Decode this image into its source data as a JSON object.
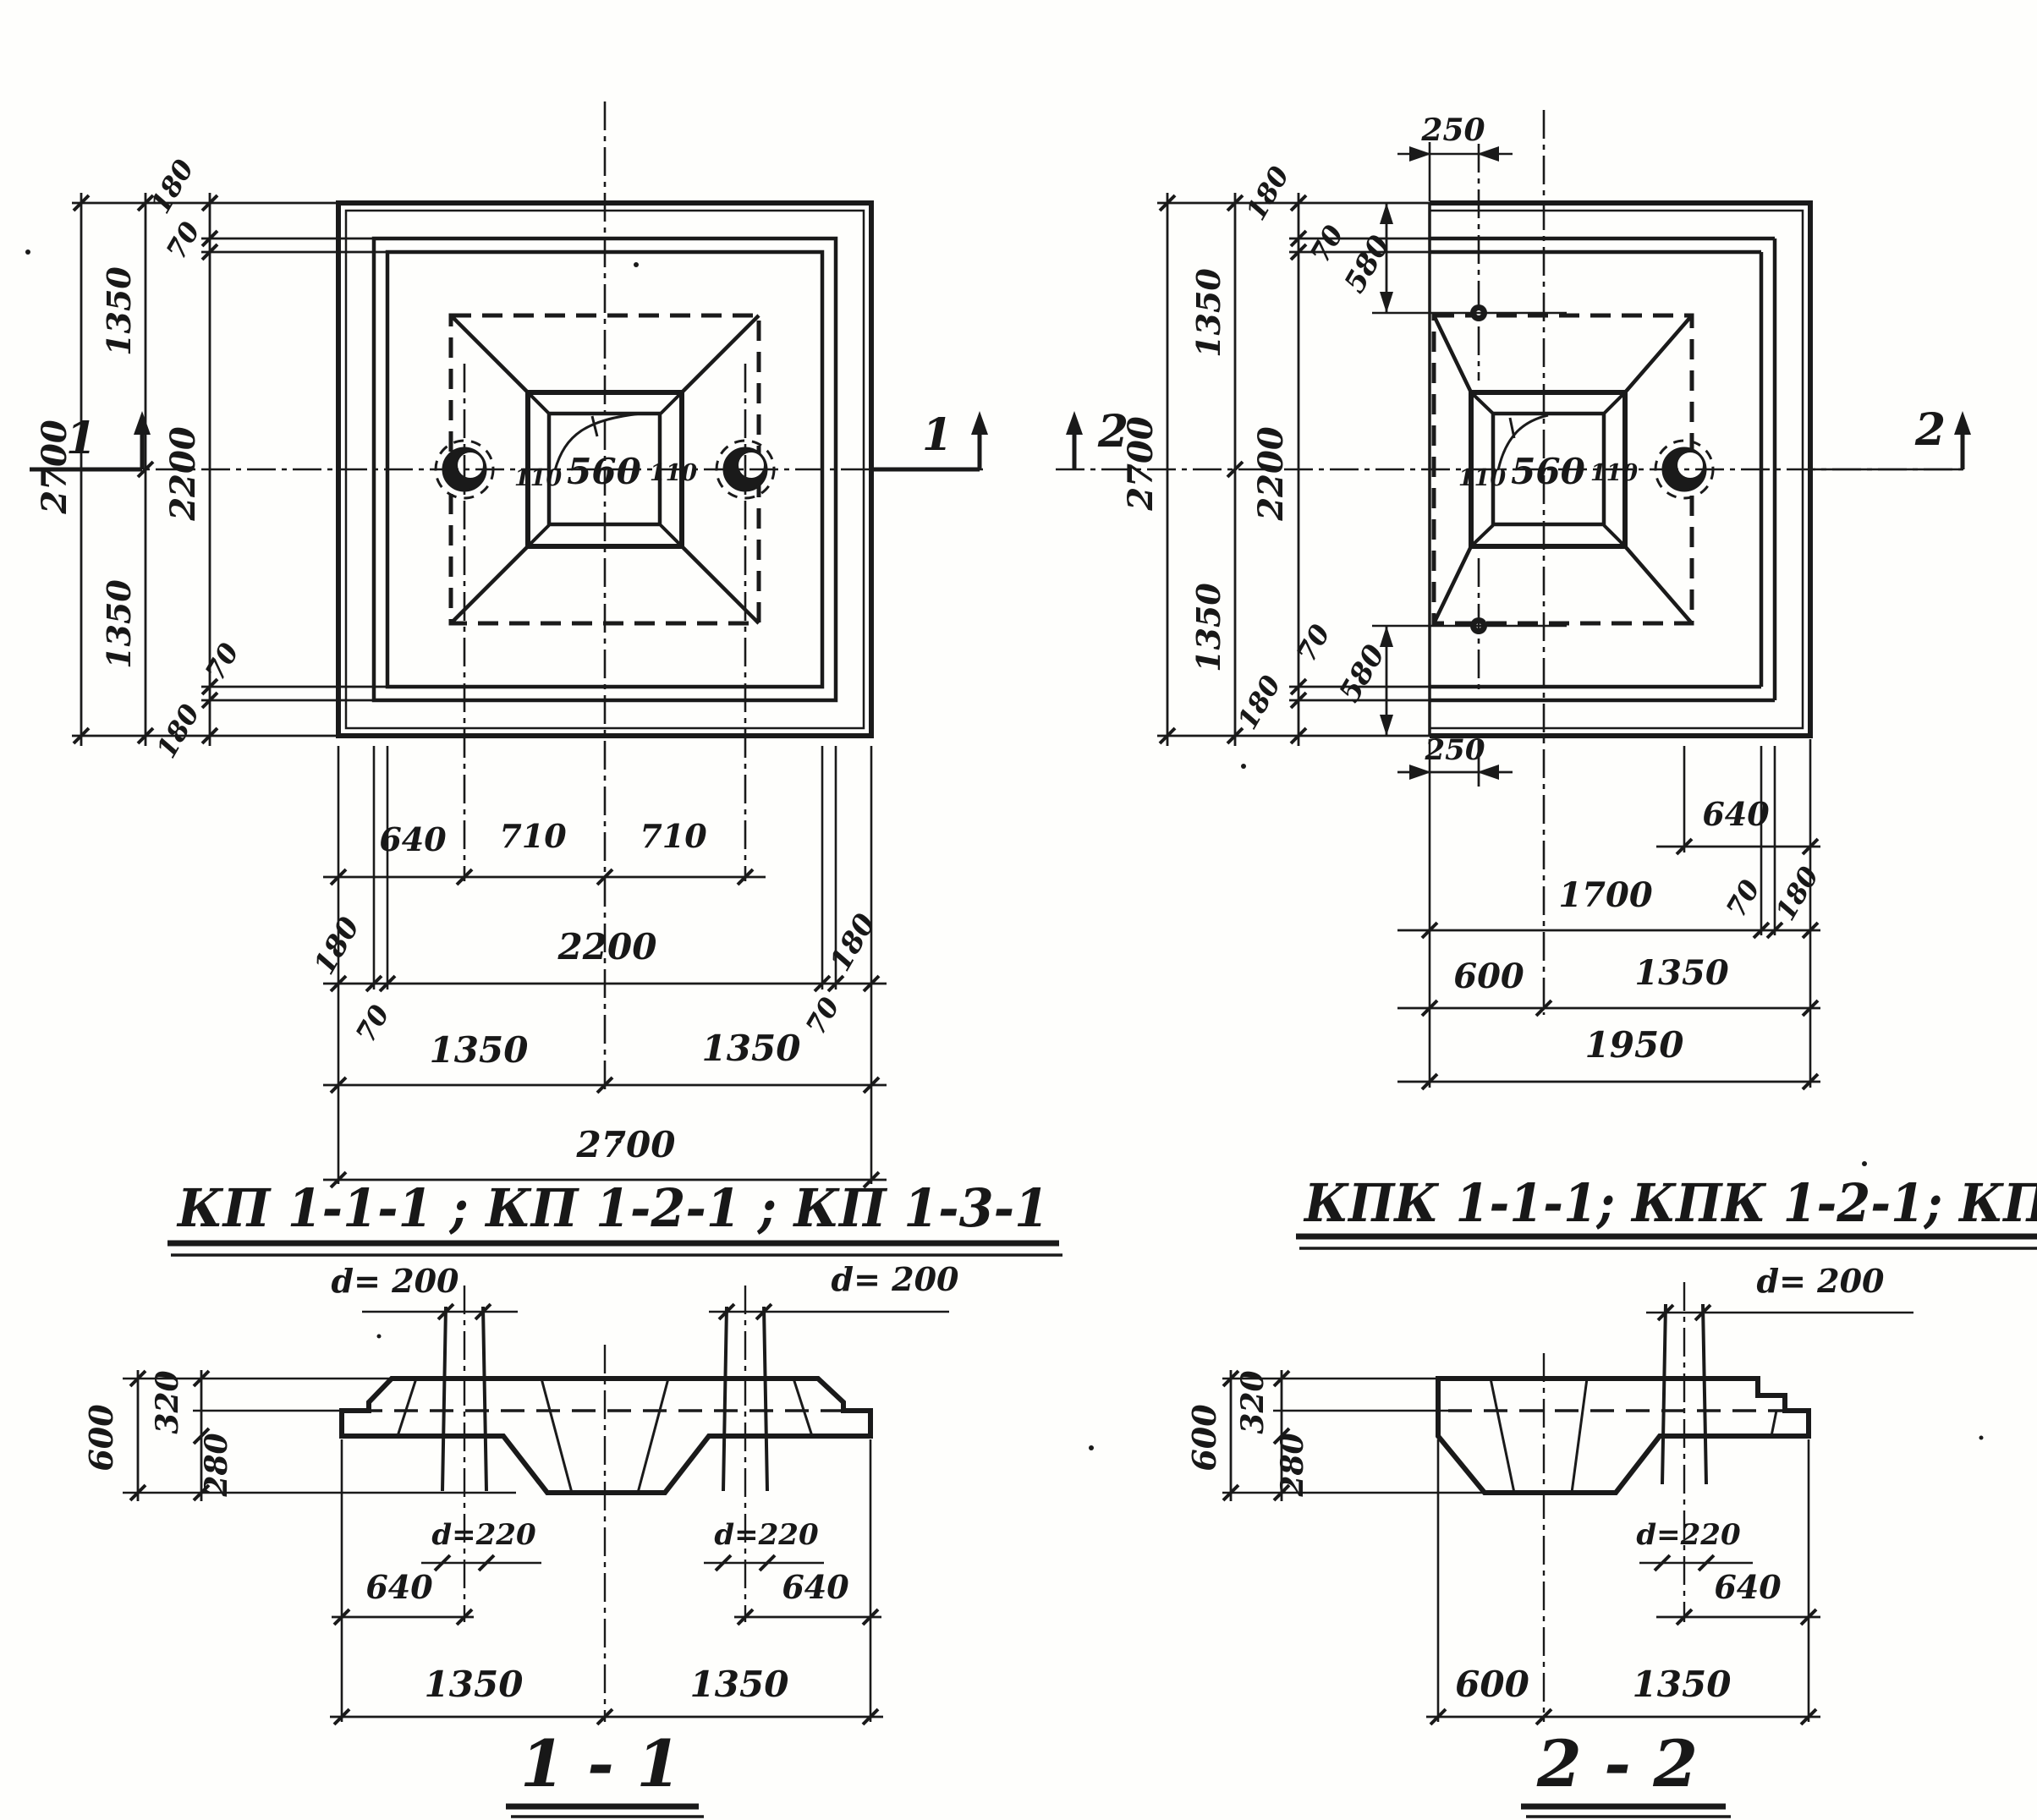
{
  "ink": "#1a1a1a",
  "paper": "#fefefc",
  "heading_left": "КП 1-1-1 ; КП 1-2-1 ; КП 1-3-1",
  "heading_right": "КПК 1-1-1; КПК 1-2-1; КПК 1-3-1",
  "plan_left": {
    "marker": "1",
    "v2700": "2700",
    "v1350t": "1350",
    "v1350b": "1350",
    "v2200": "2200",
    "v180t": "180",
    "v70t": "70",
    "v70b": "70",
    "v180b": "180",
    "s110l": "110",
    "s560": "560",
    "s110r": "110",
    "b640": "640",
    "b710l": "710",
    "b710r": "710",
    "b180l": "180",
    "b2200": "2200",
    "b180r": "180",
    "b70l": "70",
    "b70r": "70",
    "b1350l": "1350",
    "b1350r": "1350",
    "b2700": "2700"
  },
  "plan_right": {
    "marker": "2",
    "t250": "250",
    "v2700": "2700",
    "v1350t": "1350",
    "v1350b": "1350",
    "v2200": "2200",
    "v180t": "180",
    "v70t": "70",
    "v580t": "580",
    "v70b": "70",
    "v580b": "580",
    "v180b": "180",
    "s110l": "110",
    "s560": "560",
    "s110r": "110",
    "b250": "250",
    "b640": "640",
    "b1700": "1700",
    "b70": "70",
    "b180": "180",
    "b600": "600",
    "b1350": "1350",
    "b1950": "1950"
  },
  "section_1": {
    "title": "1 - 1",
    "d200l": "d= 200",
    "d200r": "d= 200",
    "d220l": "d=220",
    "d220r": "d=220",
    "h600": "600",
    "h320": "320",
    "h280": "280",
    "w640l": "640",
    "w640r": "640",
    "w1350l": "1350",
    "w1350r": "1350"
  },
  "section_2": {
    "title": "2 - 2",
    "d200": "d= 200",
    "d220": "d=220",
    "h600": "600",
    "h320": "320",
    "h280": "280",
    "w640": "640",
    "w600": "600",
    "w1350": "1350"
  }
}
